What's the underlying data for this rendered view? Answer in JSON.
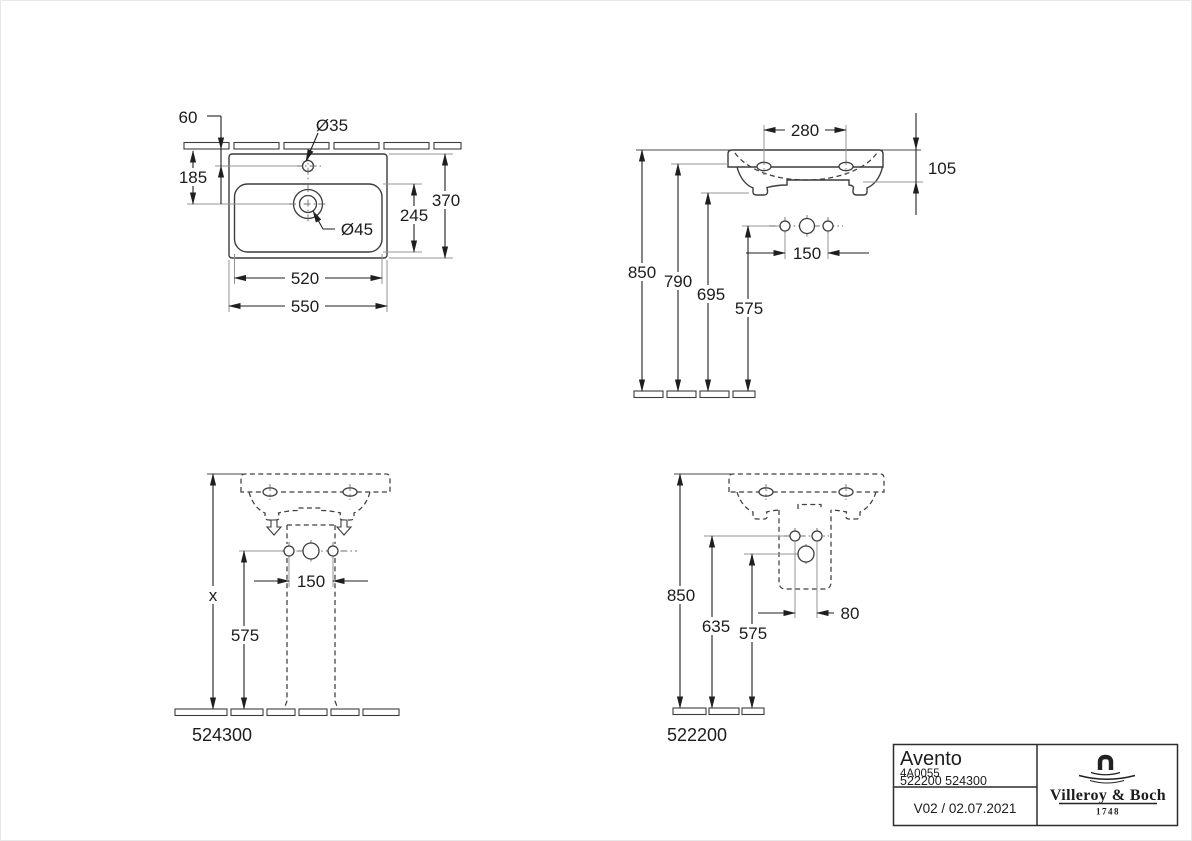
{
  "page": {
    "background": "#ffffff",
    "line_color": "#3c3c3c",
    "dimension_color": "#1f1f1f",
    "extension_line_color": "#949494"
  },
  "views": {
    "plan": {
      "description": "washbasin top view",
      "labels": {
        "rear_offset": "60",
        "faucet_hole_dia": "Ø35",
        "faucet_depth": "185",
        "inner_depth": "245",
        "total_depth": "370",
        "drain_hole_dia": "Ø45",
        "inner_width": "520",
        "total_width": "550"
      }
    },
    "front": {
      "description": "washbasin front elevation",
      "labels": {
        "mount_hole_spacing": "280",
        "rim_height": "105",
        "height_rim_top": "850",
        "height_rim_bottom": "790",
        "height_body_bottom": "695",
        "height_fixing_holes": "575",
        "fixing_hole_spacing": "150"
      }
    },
    "front_pedestal": {
      "description": "front view with pedestal",
      "labels": {
        "height_variable": "x",
        "fixing_hole_spacing": "150",
        "height_fixing_holes": "575"
      },
      "model_number": "524300"
    },
    "side_compact": {
      "description": "view with siphon cover",
      "labels": {
        "height_rim_top": "850",
        "height_upper_holes": "635",
        "height_lower_hole": "575",
        "hole_spacing": "80"
      },
      "model_number": "522200"
    }
  },
  "title_block": {
    "series": "Avento",
    "article_number": "4A0055",
    "model_numbers": "522200 524300",
    "version_date": "V02 / 02.07.2021",
    "brand": {
      "name": "Villeroy & Boch",
      "founded": "1748"
    }
  }
}
